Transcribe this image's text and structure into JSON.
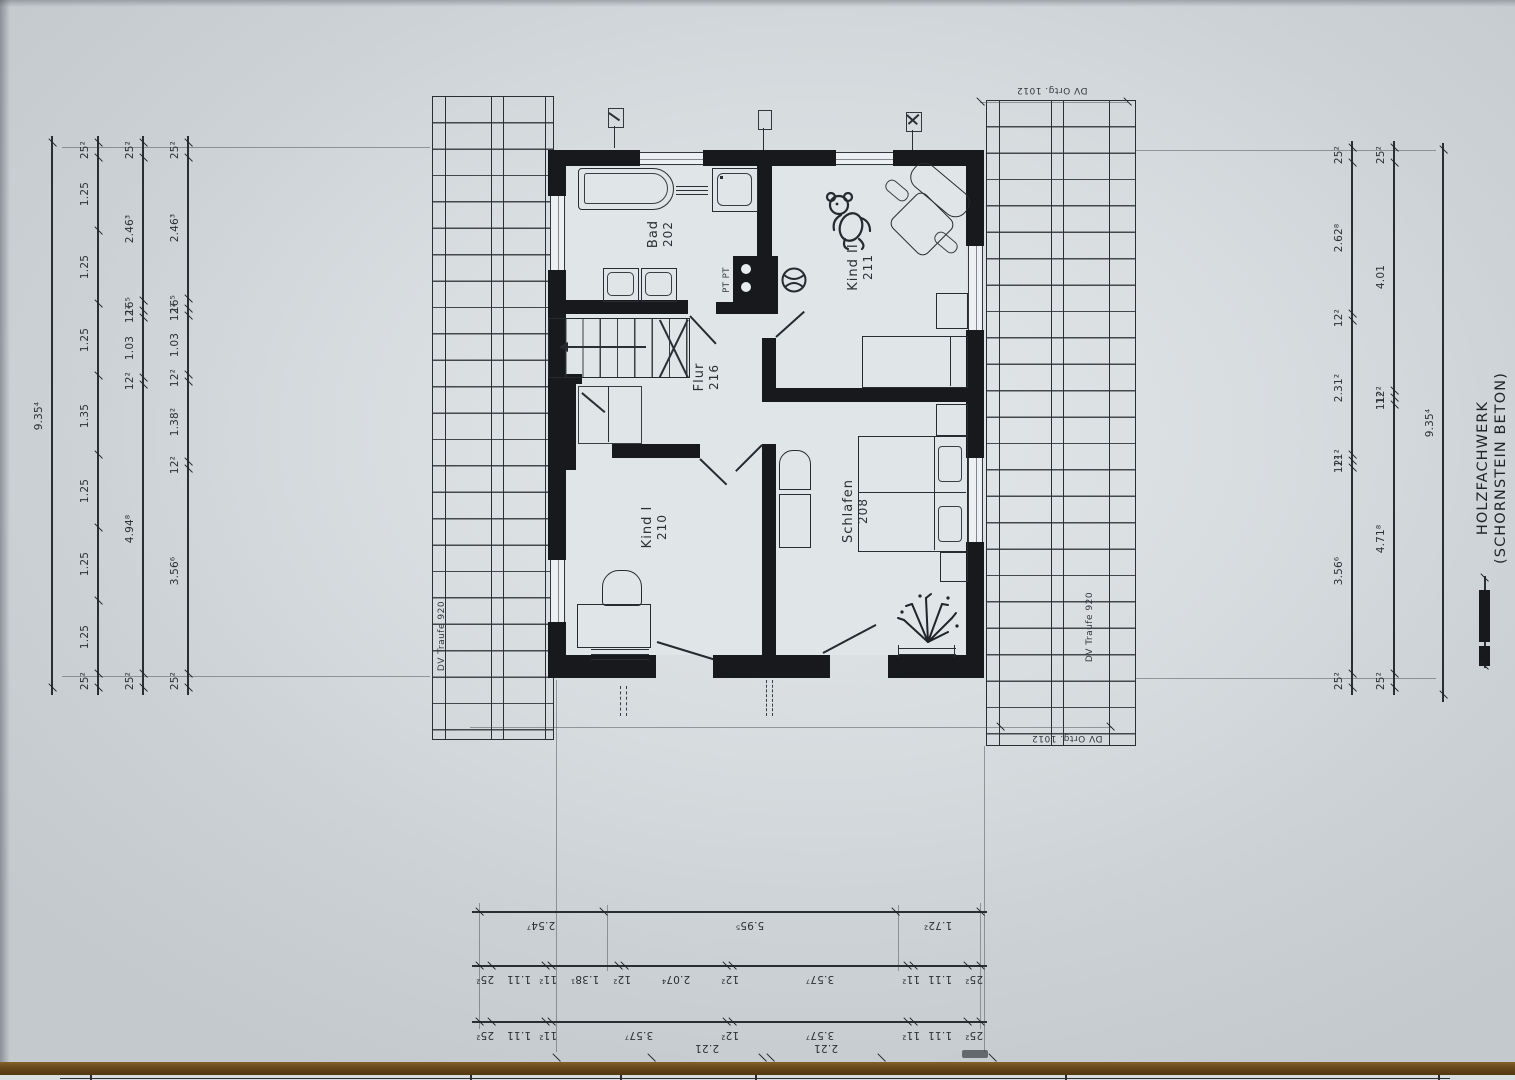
{
  "sheet": {
    "rooms": [
      {
        "name": "Bad",
        "number": "202"
      },
      {
        "name": "Kind II",
        "number": "211"
      },
      {
        "name": "Flur",
        "number": "216"
      },
      {
        "name": "Kind I",
        "number": "210"
      },
      {
        "name": "Schlafen",
        "number": "208"
      }
    ],
    "chimney_label": "PT PT",
    "notes": {
      "left_eaves": "DV Traufe 920",
      "right_eaves": "DV Traufe 920",
      "top_gable": "DV Ortg. 1012",
      "bottom_gable": "DV Ortg. 1012"
    },
    "legend": {
      "line1": "HOLZFACHWERK",
      "line2": "(SCHORNSTEIN BETON)"
    },
    "ink_color": "#17191c",
    "paper_color": "#d7dcdf"
  },
  "dims": {
    "left_total": [
      {
        "t": "9.35⁴",
        "m": 9.354
      }
    ],
    "left_a": [
      {
        "t": "25²",
        "m": 0.252
      },
      {
        "t": "1.25",
        "m": 1.25
      },
      {
        "t": "1.25",
        "m": 1.25
      },
      {
        "t": "1.25",
        "m": 1.25
      },
      {
        "t": "1.35",
        "m": 1.35
      },
      {
        "t": "1.25",
        "m": 1.25
      },
      {
        "t": "1.25",
        "m": 1.25
      },
      {
        "t": "1.25",
        "m": 1.25
      },
      {
        "t": "25²",
        "m": 0.252
      }
    ],
    "left_b": [
      {
        "t": "25²",
        "m": 0.252
      },
      {
        "t": "2.46³",
        "m": 2.463
      },
      {
        "t": "16⁵",
        "m": 0.165
      },
      {
        "t": "12²",
        "m": 0.122
      },
      {
        "t": "1.03",
        "m": 1.03
      },
      {
        "t": "12²",
        "m": 0.122
      },
      {
        "t": "4.94⁸",
        "m": 4.948
      },
      {
        "t": "25²",
        "m": 0.252
      }
    ],
    "left_c": [
      {
        "t": "25²",
        "m": 0.252
      },
      {
        "t": "2.46³",
        "m": 2.463
      },
      {
        "t": "16⁵",
        "m": 0.165
      },
      {
        "t": "12²",
        "m": 0.122
      },
      {
        "t": "1.03",
        "m": 1.03
      },
      {
        "t": "12²",
        "m": 0.122
      },
      {
        "t": "1.38²",
        "m": 1.382
      },
      {
        "t": "12²",
        "m": 0.122
      },
      {
        "t": "3.56⁶",
        "m": 3.566
      },
      {
        "t": "25²",
        "m": 0.252
      }
    ],
    "right_a": [
      {
        "t": "25²",
        "m": 0.252
      },
      {
        "t": "2.62⁸",
        "m": 2.628
      },
      {
        "t": "12²",
        "m": 0.122
      },
      {
        "t": "2.31²",
        "m": 2.312
      },
      {
        "t": "11²",
        "m": 0.112
      },
      {
        "t": "12²",
        "m": 0.122
      },
      {
        "t": "3.56⁶",
        "m": 3.566
      },
      {
        "t": "25²",
        "m": 0.252
      }
    ],
    "right_b": [
      {
        "t": "25²",
        "m": 0.252
      },
      {
        "t": "4.01",
        "m": 4.01
      },
      {
        "t": "12²",
        "m": 0.122
      },
      {
        "t": "11²",
        "m": 0.112
      },
      {
        "t": "4.71⁸",
        "m": 4.718
      },
      {
        "t": "25²",
        "m": 0.252
      }
    ],
    "right_total": [
      {
        "t": "9.35⁴",
        "m": 9.354
      }
    ],
    "bottom_a": [
      {
        "t": "2.54⁷",
        "m": 2.547
      },
      {
        "t": "5.95⁵",
        "m": 5.955
      },
      {
        "t": "1.72²",
        "m": 1.722
      }
    ],
    "bottom_b": [
      {
        "t": "25²",
        "m": 0.252
      },
      {
        "t": "1.11",
        "m": 1.11
      },
      {
        "t": "11²",
        "m": 0.112
      },
      {
        "t": "1.38¹",
        "m": 1.381
      },
      {
        "t": "12²",
        "m": 0.122
      },
      {
        "t": "2.07⁴",
        "m": 2.074
      },
      {
        "t": "12²",
        "m": 0.122
      },
      {
        "t": "3.57⁷",
        "m": 3.577
      },
      {
        "t": "11²",
        "m": 0.112
      },
      {
        "t": "1.11",
        "m": 1.11
      },
      {
        "t": "25²",
        "m": 0.252
      }
    ],
    "bottom_c": [
      {
        "t": "25²",
        "m": 0.252
      },
      {
        "t": "1.11",
        "m": 1.11
      },
      {
        "t": "11²",
        "m": 0.112
      },
      {
        "t": "3.57⁷",
        "m": 3.577
      },
      {
        "t": "12²",
        "m": 0.122
      },
      {
        "t": "3.57⁷",
        "m": 3.577
      },
      {
        "t": "11²",
        "m": 0.112
      },
      {
        "t": "1.11",
        "m": 1.11
      },
      {
        "t": "25²",
        "m": 0.252
      }
    ],
    "bottom_d": [
      {
        "t": "",
        "m": 1.9
      },
      {
        "t": "2.21",
        "m": 2.21
      },
      {
        "t": "",
        "m": 0.15
      },
      {
        "t": "2.21",
        "m": 2.21
      },
      {
        "t": "",
        "m": 2.2
      }
    ]
  }
}
